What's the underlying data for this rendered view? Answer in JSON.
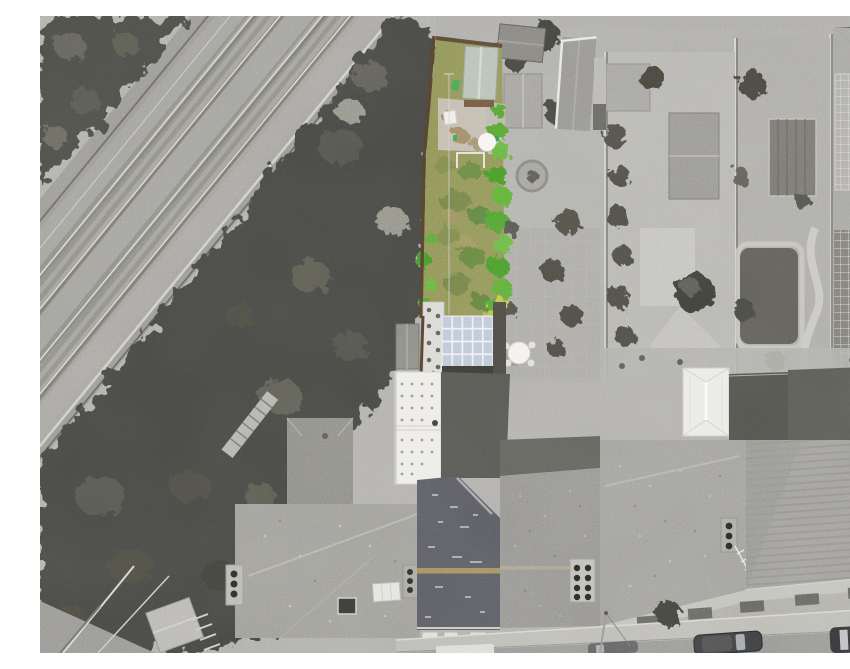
{
  "scene": {
    "kind": "aerial-drone-photograph",
    "treatment": "selective-colour: subject property garden in colour, surroundings greyscale",
    "features": [
      {
        "name": "railway-tracks",
        "label": "twin railway tracks running diagonally, top-left"
      },
      {
        "name": "embankment-trees",
        "label": "dense tree belt between railway and gardens"
      },
      {
        "name": "subject-garden",
        "label": "long narrow lawn with bright green hedges (in colour)"
      },
      {
        "name": "garden-shed-teal",
        "label": "sage-green shed roof at top of garden"
      },
      {
        "name": "satellite-dish",
        "label": "white circular dish / table in garden"
      },
      {
        "name": "goal-frame",
        "label": "small white goal frame on lawn"
      },
      {
        "name": "stepping-stone-path",
        "label": "pale side-return with round stepping stones"
      },
      {
        "name": "glazed-roof",
        "label": "blue-tinted glazed conservatory roof grid"
      },
      {
        "name": "rear-extension-roof",
        "label": "white flat roof with rows of fixings"
      },
      {
        "name": "subject-main-roof",
        "label": "dark slate roof with tan ridge tiles"
      },
      {
        "name": "neighbour-gardens",
        "label": "greyscale gardens with sheds, lawns and paths"
      },
      {
        "name": "conservatory",
        "label": "white hipped conservatory, lower right"
      },
      {
        "name": "street",
        "label": "road with parked cars along bottom edge"
      }
    ]
  },
  "palette": {
    "grass": "#85894f",
    "dirt": "#bdb5a7",
    "shedTeal": "#aebbae",
    "shedTealRidge": "#c9d4c7",
    "fenceBrown": "#4c3a28",
    "brownWall": "#6b5138",
    "glass": "#b7c3d3",
    "ridgeTan": "#9a8457",
    "binGreen": "#3da04b",
    "slate": "#53545a",
    "extensionWhite": "#ebeae5",
    "hedgeGreen": "#4f9a2c",
    "hedgeLight": "#62b23e",
    "hedgeDark": "#3f8f24",
    "shrubYellow": "#b8c33f",
    "treeGrey": "#41413c",
    "ballastGrey": "#908f8a",
    "roofGrey": "#96958f",
    "pavement": "#b6b5af",
    "road": "#8e8e8a"
  }
}
